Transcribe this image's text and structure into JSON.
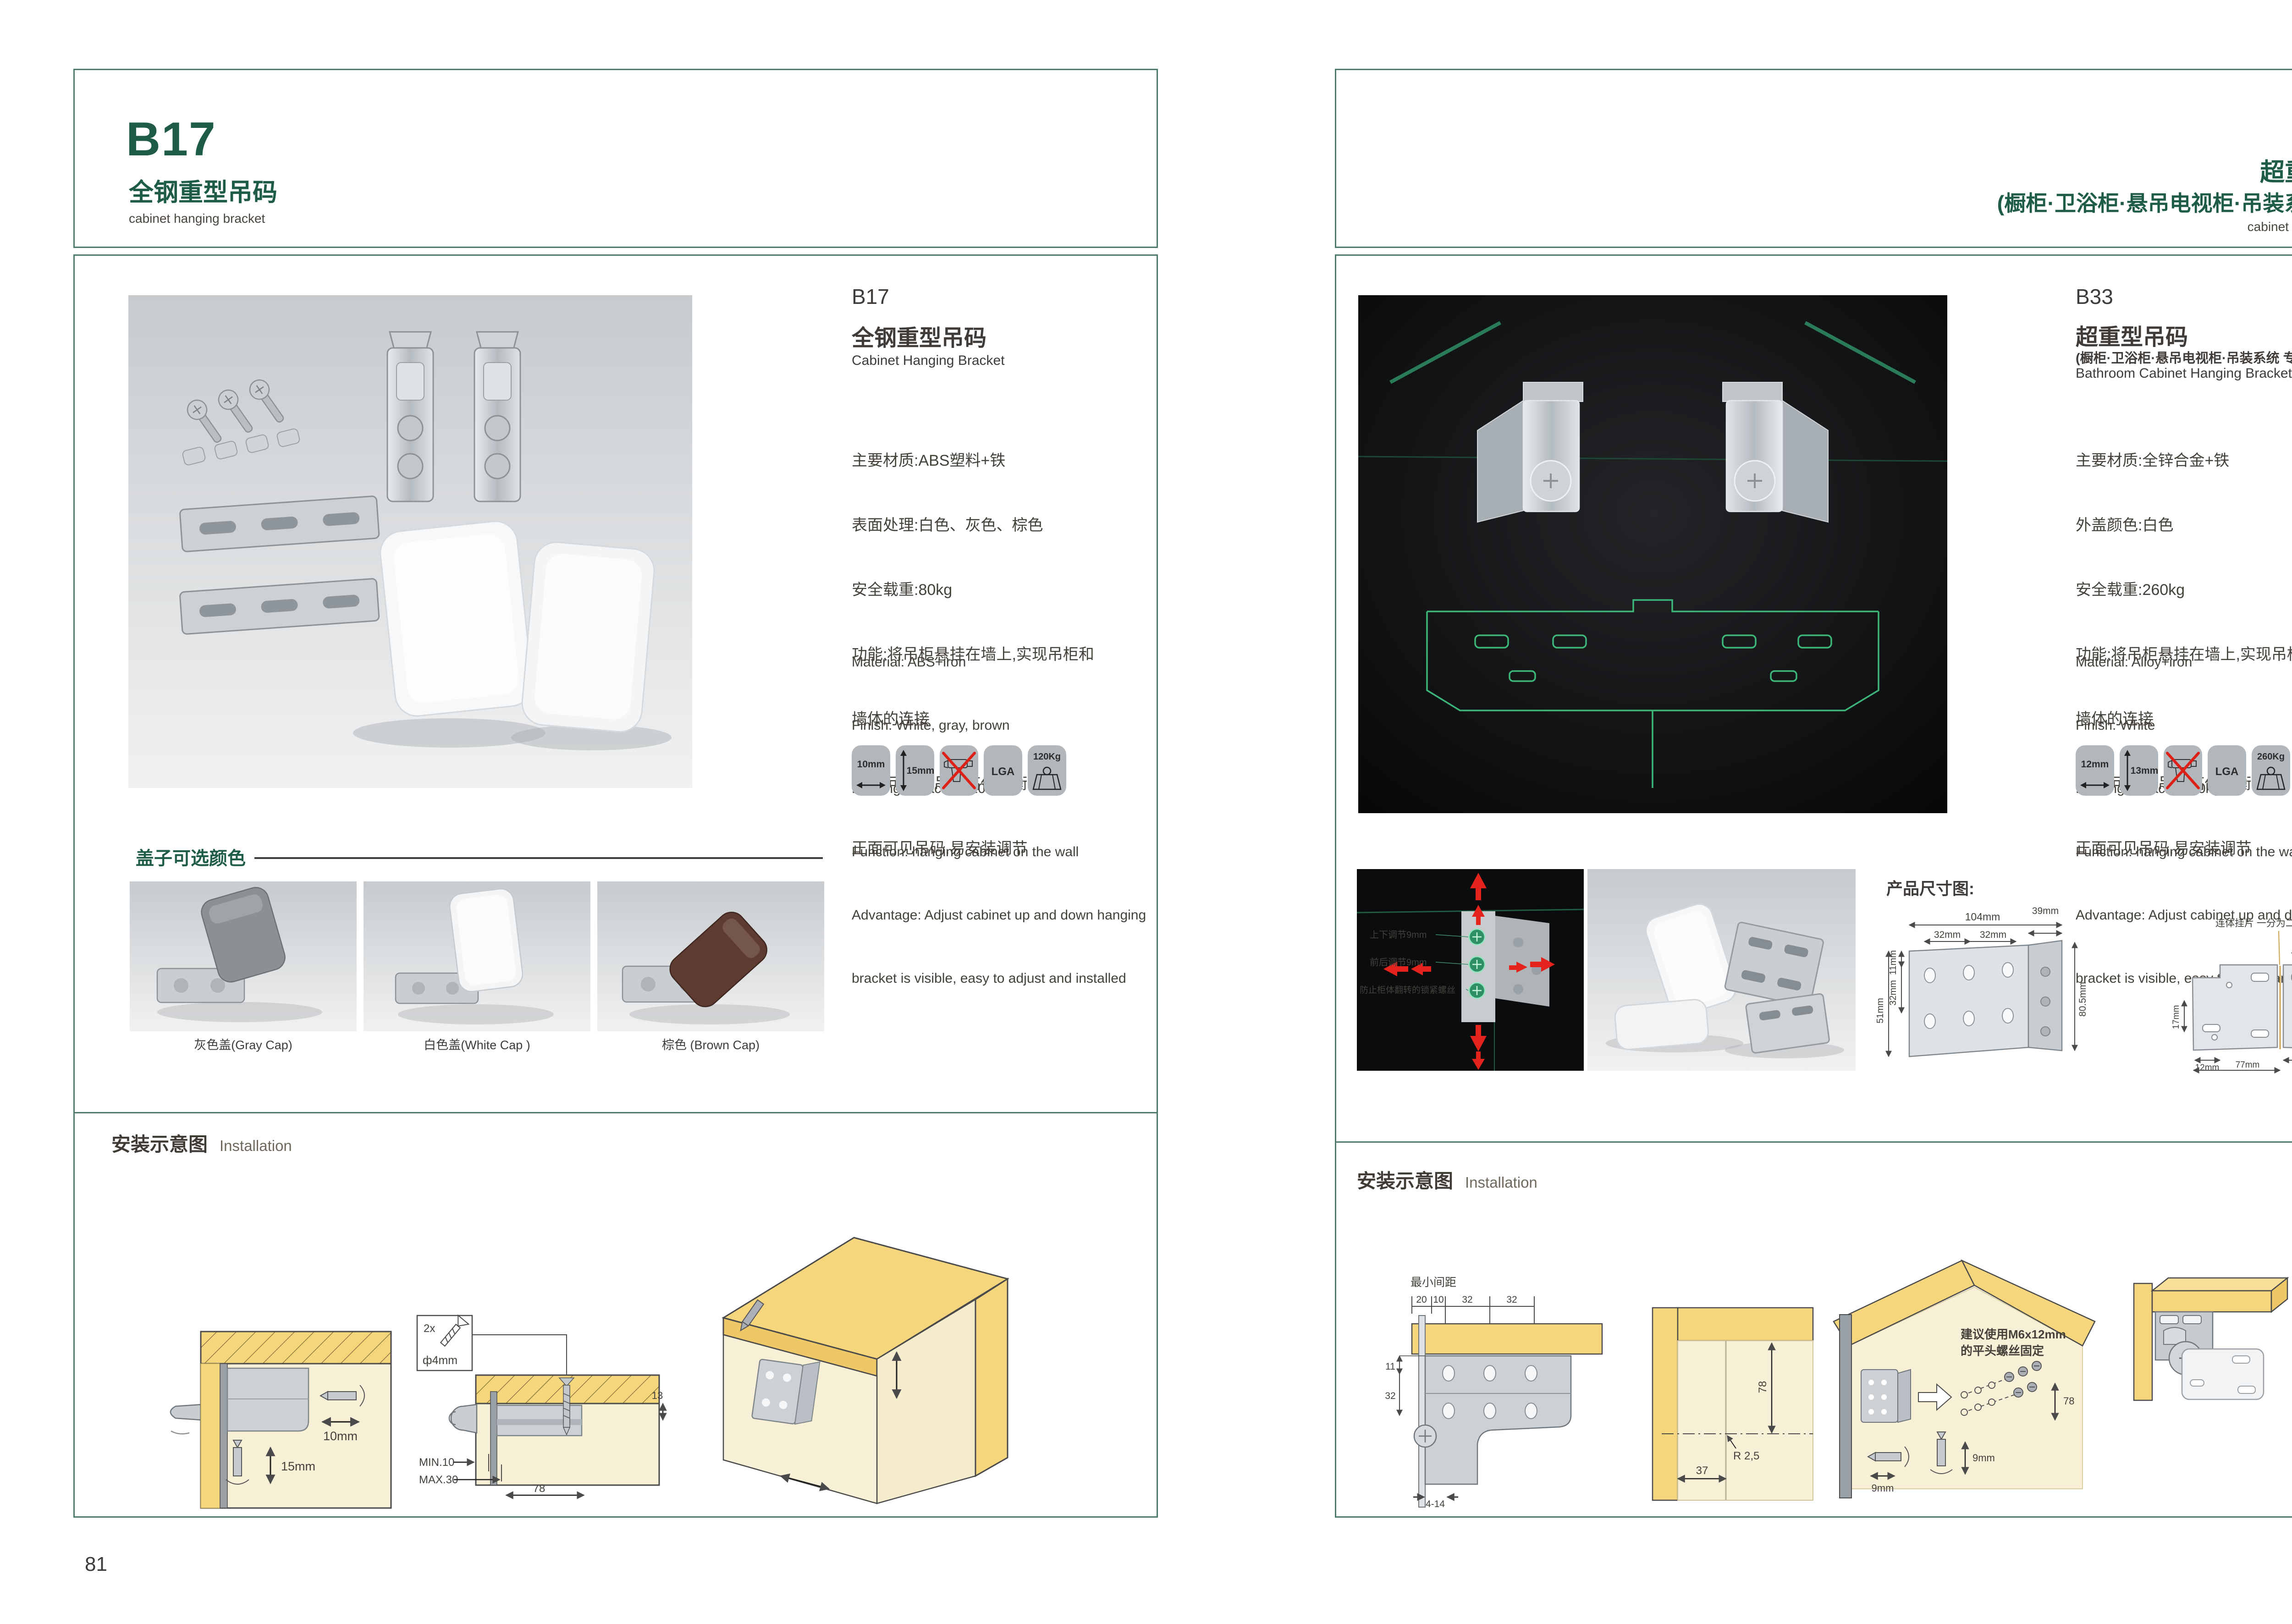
{
  "page_left": {
    "page_number": "81",
    "header": {
      "code": "B17",
      "title_cn": "全钢重型吊码",
      "title_en": "cabinet hanging bracket"
    },
    "product": {
      "code": "B17",
      "name_cn": "全钢重型吊码",
      "name_en": "Cabinet Hanging Bracket",
      "specs_cn": [
        "主要材质:ABS塑料+铁",
        "表面处理:白色、灰色、棕色",
        "安全载重:80kg",
        "功能:将吊柜悬挂在墙上,实现吊柜和",
        "墙体的连接",
        "优点:可调节吊柜高低平衡",
        "正面可见吊码,易安装调节"
      ],
      "specs_en": [
        "Material: ABS+iron",
        "Finish: White, gray, brown",
        "Loading capacity: 120kg",
        "Function: hanging cabinet on the wall",
        "Advantage: Adjust cabinet up and down hanging",
        "bracket is visible, easy to adjust and installed"
      ],
      "badges": [
        {
          "icon": "width-arrow",
          "label": "10mm"
        },
        {
          "icon": "height-arrow",
          "label": "15mm"
        },
        {
          "icon": "no-drill",
          "label": ""
        },
        {
          "icon": "lga",
          "label": "LGA"
        },
        {
          "icon": "weight",
          "label": "120Kg"
        }
      ]
    },
    "caps": {
      "title": "盖子可选颜色",
      "items": [
        {
          "label": "灰色盖(Gray Cap)",
          "color": "#8d9093"
        },
        {
          "label": "白色盖(White Cap )",
          "color": "#f4f5f6"
        },
        {
          "label": "棕色 (Brown Cap)",
          "color": "#5e3b31"
        }
      ]
    },
    "installation": {
      "title_cn": "安装示意图",
      "title_en": "Installation",
      "d1": {
        "dim_width": "10mm",
        "dim_height": "15mm"
      },
      "d2": {
        "screw_count": "2x",
        "screw_dia": "ф4mm",
        "dim_min": "MIN.10",
        "dim_max": "MAX.30",
        "dim_78": "78",
        "dim_13": "13"
      }
    }
  },
  "page_right": {
    "page_number": "82",
    "header": {
      "code": "B33",
      "title_cn": "超重型吊码",
      "subtitle_cn": "(橱柜·卫浴柜·悬吊电视柜·吊装系统 专用)",
      "title_en": "cabinet hanging bracket"
    },
    "product": {
      "code": "B33",
      "name_cn": "超重型吊码",
      "subtitle_cn": "(橱柜·卫浴柜·悬吊电视柜·吊装系统 专用)",
      "name_en": "Bathroom Cabinet Hanging Bracket",
      "specs_cn": [
        "主要材质:全锌合金+铁",
        "外盖颜色:白色",
        "安全载重:260kg",
        "功能:将吊柜悬挂在墙上,实现吊柜和",
        "墙体的连接",
        "优点:可调节吊柜高低平衡",
        "正面可见吊码,易安装调节"
      ],
      "specs_en": [
        "Material: Alloy+iron",
        "Finish: White",
        "Loading capacity:260kg",
        "Function: hanging cabinet on the wall",
        "Advantage: Adjust cabinet up and down hanging",
        "bracket is visible, easy to adjust and installed"
      ],
      "badges": [
        {
          "icon": "width-arrow",
          "label": "12mm"
        },
        {
          "icon": "height-arrow",
          "label": "13mm"
        },
        {
          "icon": "no-drill",
          "label": ""
        },
        {
          "icon": "lga",
          "label": "LGA"
        },
        {
          "icon": "weight",
          "label": "260Kg"
        }
      ]
    },
    "photo_annotations": {
      "a1": "上下调节9mm",
      "a2": "前后调节9mm",
      "a3": "防止柜体翻转的锁紧螺丝"
    },
    "dimensions": {
      "title": "产品尺寸图:",
      "d1": {
        "w_total": "104mm",
        "w_seg1": "32mm",
        "w_seg2": "32mm",
        "depth": "39mm",
        "h_seg1": "11mm",
        "h_seg2": "32mm",
        "h_seg3": "51mm",
        "h_total": "80.5mm"
      },
      "d2": {
        "label": "连体挂片 一分为二",
        "top": "55mm",
        "right_inner": "39mm",
        "right_outer": "55mm",
        "right_small": "8mm",
        "left": "17mm",
        "bottom_small": "12mm",
        "bottom_total": "77mm",
        "bottom_right": "63mm"
      }
    },
    "installation": {
      "title_cn": "安装示意图",
      "title_en": "Installation",
      "d1": {
        "label": "最小间距",
        "t1": "20",
        "t2": "10",
        "t3": "32",
        "t4": "32",
        "l1": "11",
        "l2": "32",
        "b1": "4-14"
      },
      "d2": {
        "v": "78",
        "r": "R 2,5",
        "b": "37"
      },
      "d3": {
        "note1": "建议使用M6x12mm",
        "note2": "的平头螺丝固定",
        "h9": "9mm",
        "v9": "9mm",
        "gap": "78"
      }
    }
  }
}
